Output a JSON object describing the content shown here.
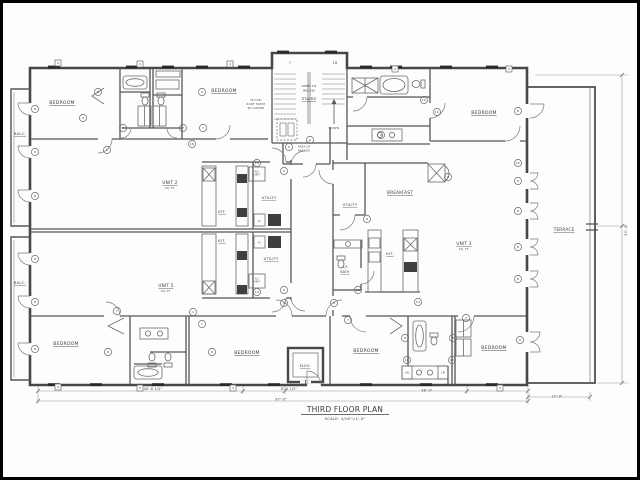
{
  "drawing": {
    "title_block": {
      "title": "THIRD FLOOR PLAN",
      "scale": "SCALE: 3/16\"=1'-0\""
    },
    "colors": {
      "wall": "#474747",
      "interior_wall": "#565656",
      "fixture": "#6a6a6a",
      "dimension": "#9a9a9a",
      "text": "#3d3d3d",
      "window": "#2a2a2a",
      "paper": "#fdfdfd",
      "border": "#000000"
    },
    "labels": [
      {
        "name": "room-label-bedroom-top-left",
        "text": "BEDROOM",
        "x": 62,
        "y": 104,
        "s": 4.6,
        "u": 1
      },
      {
        "name": "room-label-bedroom-top-mid",
        "text": "BEDROOM",
        "x": 224,
        "y": 92,
        "s": 4.6,
        "u": 1
      },
      {
        "name": "room-label-bedroom-top-right",
        "text": "BEDROOM",
        "x": 484,
        "y": 114,
        "s": 4.6,
        "u": 1
      },
      {
        "name": "room-label-bedroom-bottom-left",
        "text": "BEDROOM",
        "x": 66,
        "y": 345,
        "s": 4.6,
        "u": 1
      },
      {
        "name": "room-label-bedroom-bottom-mid",
        "text": "BEDROOM",
        "x": 247,
        "y": 354,
        "s": 4.6,
        "u": 1
      },
      {
        "name": "room-label-bedroom-bottom-right",
        "text": "BEDROOM",
        "x": 366,
        "y": 352,
        "s": 4.6,
        "u": 1
      },
      {
        "name": "room-label-bedroom-bottom-far-right",
        "text": "BEDROOM",
        "x": 494,
        "y": 349,
        "s": 4.6,
        "u": 1
      },
      {
        "name": "room-label-unit-2",
        "text": "UNIT 2",
        "x": 170,
        "y": 184,
        "s": 4.2,
        "u": 1
      },
      {
        "name": "room-label-unit-2-area",
        "text": "SQ. FT.",
        "x": 170,
        "y": 189,
        "s": 2.6
      },
      {
        "name": "room-label-unit-5",
        "text": "UNIT 5",
        "x": 166,
        "y": 287,
        "s": 4.2,
        "u": 1
      },
      {
        "name": "room-label-unit-5-area",
        "text": "SQ. FT.",
        "x": 166,
        "y": 292,
        "s": 2.6
      },
      {
        "name": "room-label-unit-3",
        "text": "UNIT 3",
        "x": 464,
        "y": 245,
        "s": 4.2,
        "u": 1
      },
      {
        "name": "room-label-unit-3-area",
        "text": "SQ. FT.",
        "x": 464,
        "y": 250,
        "s": 2.6
      },
      {
        "name": "room-label-kitchen-1",
        "text": "KIT.",
        "x": 222,
        "y": 213,
        "s": 3.8,
        "u": 1
      },
      {
        "name": "room-label-kitchen-2",
        "text": "KIT.",
        "x": 222,
        "y": 242,
        "s": 3.8,
        "u": 1
      },
      {
        "name": "room-label-kitchen-3",
        "text": "KIT.",
        "x": 390,
        "y": 255,
        "s": 3.8,
        "u": 1
      },
      {
        "name": "room-label-utility-1",
        "text": "UTILITY",
        "x": 269,
        "y": 199,
        "s": 3.6,
        "u": 1
      },
      {
        "name": "room-label-utility-2",
        "text": "UTILITY",
        "x": 271,
        "y": 260,
        "s": 3.6,
        "u": 1
      },
      {
        "name": "room-label-utility-3",
        "text": "UTILITY",
        "x": 350,
        "y": 206,
        "s": 3.6,
        "u": 1
      },
      {
        "name": "room-label-breakfast",
        "text": "BREAKFAST",
        "x": 400,
        "y": 194,
        "s": 4.2,
        "u": 1
      },
      {
        "name": "room-label-half-bath-1",
        "text": "1/2",
        "x": 345,
        "y": 268,
        "s": 3.2
      },
      {
        "name": "room-label-half-bath-2",
        "text": "BATH",
        "x": 345,
        "y": 273,
        "s": 3.2,
        "u": 1
      },
      {
        "name": "room-label-balcony-1",
        "text": "BALC.",
        "x": 20,
        "y": 135,
        "s": 3.8,
        "u": 1
      },
      {
        "name": "room-label-balcony-2",
        "text": "BALC.",
        "x": 20,
        "y": 284,
        "s": 3.8,
        "u": 1
      },
      {
        "name": "room-label-terrace",
        "text": "TERRACE",
        "x": 564,
        "y": 231,
        "s": 4.2,
        "u": 1
      },
      {
        "name": "room-label-elevator",
        "text": "ELEV.",
        "x": 305,
        "y": 367,
        "s": 3.6,
        "u": 1
      },
      {
        "name": "stair-note-open-to",
        "text": "OPEN TO",
        "x": 309,
        "y": 87,
        "s": 3
      },
      {
        "name": "stair-note-below",
        "text": "BELOW",
        "x": 309,
        "y": 91.5,
        "s": 3
      },
      {
        "name": "stair-label",
        "text": "STAIRS",
        "x": 309,
        "y": 100,
        "s": 3.8,
        "u": 1
      },
      {
        "name": "stair-note-down",
        "text": "DOWN",
        "x": 334,
        "y": 129,
        "s": 2.8
      },
      {
        "name": "roof-hatch-note-1",
        "text": "36\"x36\"",
        "x": 256,
        "y": 101,
        "s": 2.6
      },
      {
        "name": "roof-hatch-note-2",
        "text": "ROOF HATCH",
        "x": 256,
        "y": 105,
        "s": 2.6
      },
      {
        "name": "roof-hatch-note-3",
        "text": "W/ LADDER",
        "x": 256,
        "y": 109,
        "s": 2.6
      },
      {
        "name": "area-of-refuge-note-1",
        "text": "AREA OF",
        "x": 304,
        "y": 147.5,
        "s": 2.6
      },
      {
        "name": "area-of-refuge-note-2",
        "text": "REFUGE",
        "x": 304,
        "y": 151.5,
        "s": 2.6
      },
      {
        "name": "stair-grid-number-7",
        "text": "7",
        "x": 290,
        "y": 64,
        "s": 3.5
      },
      {
        "name": "stair-grid-number-16",
        "text": "16",
        "x": 335,
        "y": 64,
        "s": 3.5
      },
      {
        "name": "ac-unit-note-1a",
        "text": "A/C",
        "x": 257,
        "y": 172.5,
        "s": 2.2
      },
      {
        "name": "ac-unit-note-1b",
        "text": "UNIT",
        "x": 257,
        "y": 175.5,
        "s": 2.2
      },
      {
        "name": "ac-unit-note-2a",
        "text": "A/C",
        "x": 257,
        "y": 279.5,
        "s": 2.2
      },
      {
        "name": "ac-unit-note-2b",
        "text": "UNIT",
        "x": 257,
        "y": 282.5,
        "s": 2.2
      },
      {
        "name": "dryer-label-1",
        "text": "D",
        "x": 259.5,
        "y": 222,
        "s": 3
      },
      {
        "name": "dryer-label-2",
        "text": "D",
        "x": 259.5,
        "y": 243.5,
        "s": 3
      },
      {
        "name": "linen-label-1",
        "text": "LN",
        "x": 407,
        "y": 373.5,
        "s": 2.6
      },
      {
        "name": "linen-label-2",
        "text": "LN",
        "x": 443,
        "y": 373.5,
        "s": 2.6
      },
      {
        "name": "dim-40-6-half",
        "text": "40'-6 1/2\"",
        "x": 153,
        "y": 390,
        "s": 3.4
      },
      {
        "name": "dim-8-4-half",
        "text": "8'-4 1/2\"",
        "x": 289,
        "y": 390,
        "s": 3.4
      },
      {
        "name": "dim-36-0",
        "text": "36'-0\"",
        "x": 427,
        "y": 391.5,
        "s": 3.4
      },
      {
        "name": "dim-97-0",
        "text": "97'-0\"",
        "x": 281,
        "y": 400.5,
        "s": 3.4
      },
      {
        "name": "dim-12-0",
        "text": "12'-0\"",
        "x": 557,
        "y": 397.5,
        "s": 3.4
      },
      {
        "name": "dim-30-0",
        "text": "30'-0\"",
        "x": 627,
        "y": 230,
        "s": 3.4,
        "rot": -90
      }
    ],
    "tags": {
      "circles": [
        {
          "n": "6",
          "x": 98,
          "y": 92
        },
        {
          "n": "6",
          "x": 202,
          "y": 92
        },
        {
          "n": "9",
          "x": 83,
          "y": 118
        },
        {
          "n": "7",
          "x": 123,
          "y": 128
        },
        {
          "n": "7",
          "x": 183,
          "y": 128
        },
        {
          "n": "7",
          "x": 203,
          "y": 128
        },
        {
          "n": "16",
          "x": 192,
          "y": 144
        },
        {
          "n": "1",
          "x": 107,
          "y": 150
        },
        {
          "n": "8",
          "x": 35,
          "y": 109
        },
        {
          "n": "8",
          "x": 35,
          "y": 152
        },
        {
          "n": "8",
          "x": 35,
          "y": 196
        },
        {
          "n": "8",
          "x": 35,
          "y": 259
        },
        {
          "n": "8",
          "x": 35,
          "y": 302
        },
        {
          "n": "8",
          "x": 35,
          "y": 349
        },
        {
          "n": "4",
          "x": 310,
          "y": 140
        },
        {
          "n": "5",
          "x": 289,
          "y": 147
        },
        {
          "n": "12",
          "x": 257,
          "y": 163
        },
        {
          "n": "9",
          "x": 284,
          "y": 171
        },
        {
          "n": "9",
          "x": 284,
          "y": 290
        },
        {
          "n": "12",
          "x": 257,
          "y": 292
        },
        {
          "n": "9",
          "x": 367,
          "y": 219
        },
        {
          "n": "10",
          "x": 358,
          "y": 290
        },
        {
          "n": "6",
          "x": 448,
          "y": 177
        },
        {
          "n": "9",
          "x": 381,
          "y": 135
        },
        {
          "n": "10",
          "x": 424,
          "y": 100
        },
        {
          "n": "10",
          "x": 437,
          "y": 112
        },
        {
          "n": "8",
          "x": 518,
          "y": 111
        },
        {
          "n": "15",
          "x": 518,
          "y": 163
        },
        {
          "n": "8",
          "x": 518,
          "y": 181
        },
        {
          "n": "8",
          "x": 518,
          "y": 211
        },
        {
          "n": "8",
          "x": 518,
          "y": 247
        },
        {
          "n": "8",
          "x": 518,
          "y": 279
        },
        {
          "n": "8",
          "x": 520,
          "y": 340
        },
        {
          "n": "7",
          "x": 117,
          "y": 311
        },
        {
          "n": "7",
          "x": 202,
          "y": 324
        },
        {
          "n": "4",
          "x": 193,
          "y": 312
        },
        {
          "n": "8",
          "x": 108,
          "y": 352
        },
        {
          "n": "8",
          "x": 212,
          "y": 352
        },
        {
          "n": "5",
          "x": 284,
          "y": 303
        },
        {
          "n": "6",
          "x": 334,
          "y": 303
        },
        {
          "n": "7",
          "x": 348,
          "y": 320
        },
        {
          "n": "14",
          "x": 418,
          "y": 302
        },
        {
          "n": "8",
          "x": 405,
          "y": 338
        },
        {
          "n": "8",
          "x": 453,
          "y": 338
        },
        {
          "n": "10",
          "x": 407,
          "y": 360
        },
        {
          "n": "10",
          "x": 452,
          "y": 360
        },
        {
          "n": "7",
          "x": 466,
          "y": 318
        }
      ],
      "squares": [
        {
          "n": "4",
          "x": 58,
          "y": 63
        },
        {
          "n": "4",
          "x": 140,
          "y": 64
        },
        {
          "n": "4",
          "x": 230,
          "y": 64
        },
        {
          "n": "4",
          "x": 395,
          "y": 69
        },
        {
          "n": "4",
          "x": 509,
          "y": 69
        },
        {
          "n": "4",
          "x": 58,
          "y": 387
        },
        {
          "n": "4",
          "x": 140,
          "y": 388
        },
        {
          "n": "4",
          "x": 233,
          "y": 388
        },
        {
          "n": "4",
          "x": 500,
          "y": 388
        }
      ]
    }
  }
}
